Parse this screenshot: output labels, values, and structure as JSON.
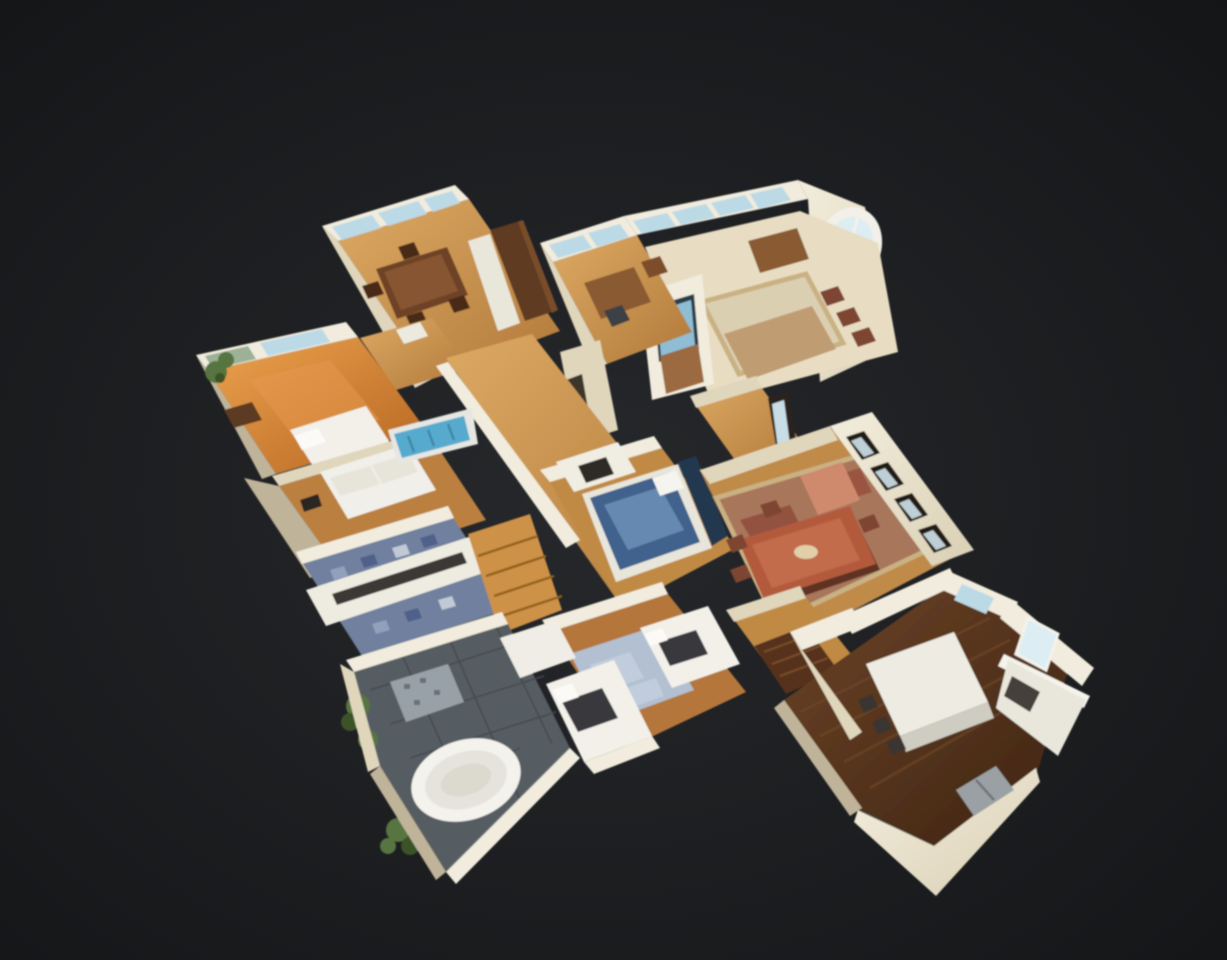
{
  "scene": {
    "description": "3D dollhouse cutaway view of a scanned single-story home interior, viewed from above at an angle, floating on a dark charcoal background with no visible UI chrome",
    "view": "dollhouse-orbit",
    "rooms": [
      {
        "name": "dining-room",
        "position": "top-left",
        "floor": "light oak",
        "features": [
          "picture-window wall",
          "dark wood dining table with chairs",
          "tall walnut hutch",
          "white cabinet"
        ]
      },
      {
        "name": "home-office",
        "position": "top-center",
        "floor": "light oak",
        "features": [
          "window wall",
          "wood desk",
          "office chair"
        ]
      },
      {
        "name": "formal-living-room",
        "position": "top-right",
        "floor": "light carpet",
        "features": [
          "arched palladian window",
          "french-window wall",
          "beige area rug",
          "tan sofa",
          "tv over fireplace",
          "writing desk",
          "row of side chairs"
        ]
      },
      {
        "name": "left-bedroom",
        "position": "left",
        "floor": "amber oak",
        "features": [
          "corner windows with greenery view",
          "white bed",
          "houseplant",
          "dresser"
        ]
      },
      {
        "name": "sitting-room",
        "position": "mid-left",
        "floor": "oak",
        "features": [
          "white loveseat",
          "wood dresser",
          "wall art"
        ]
      },
      {
        "name": "mosaic-bathroom",
        "position": "center-left",
        "floor": "blue mosaic tile",
        "features": [
          "long white double vanity"
        ]
      },
      {
        "name": "hallway-stairs",
        "position": "center",
        "floor": "light oak",
        "features": [
          "staircase with blue runner",
          "wood stair flight",
          "white cut walls"
        ]
      },
      {
        "name": "master-bedroom",
        "position": "center",
        "floor": "oak",
        "features": [
          "bed with blue duvet",
          "dark headboard",
          "white fireplace"
        ]
      },
      {
        "name": "formal-dining-room",
        "position": "right",
        "floor": "oak with red oriental rug",
        "features": [
          "long mahogany dining table",
          "dining chairs",
          "salmon armchair",
          "dark-framed french windows"
        ]
      },
      {
        "name": "kids-bedroom",
        "position": "bottom-center",
        "floor": "oak",
        "features": [
          "two white beds with dark blankets",
          "powder-blue rug"
        ]
      },
      {
        "name": "slate-bathroom",
        "position": "bottom-left",
        "floor": "slate tile",
        "features": [
          "white oval soaking tub",
          "mosaic shower pan",
          "houseplants",
          "white counter"
        ]
      },
      {
        "name": "kitchen",
        "position": "bottom-right",
        "floor": "dark walnut",
        "features": [
          "white island with stools",
          "white perimeter cabinets",
          "glass exterior door",
          "windows",
          "gray laundry appliances",
          "mudroom cut walls"
        ]
      }
    ]
  },
  "palette": {
    "bg_center": "#26282b",
    "bg_edge": "#131416",
    "wall_bright": "#f1ecdd",
    "wall_cream": "#e0d6bc",
    "wall_shadow": "#bfb49a",
    "glass": "#bcd9e6",
    "glass_bright": "#dcedf3",
    "glass_green": "#9cb196",
    "floor_travertine": "#e8ddc2",
    "floor_slate": "#575d62",
    "slate_line": "#45494d",
    "mosaic_base": "#70809e",
    "mosaic_light": "#93a0bc",
    "mosaic_dark": "#50608a",
    "mosaic_pale": "#c2c9d6",
    "rug_beige": "#dbcfb2",
    "rug_border": "#c9b183",
    "rug_oriental": "#a8765a",
    "rug_oriental_dark": "#8d4938",
    "rug_blue": "#b2c0d2",
    "table_dark_wood": "#6e4226",
    "table_mahogany": "#b35a3c",
    "table_mahogany_light": "#c4704f",
    "hutch_wood": "#5e3b21",
    "desk_wood": "#8a5a33",
    "sofa_tan": "#c09c72",
    "chair_salmon": "#cf8a6e",
    "chair_dark": "#7e4530",
    "bed_white": "#f2f0e9",
    "bed_blue": "#40628c",
    "bed_blue_light": "#6f93ba",
    "headboard_navy": "#243850",
    "blanket_dark": "#38383c",
    "plant_green": "#56743f",
    "plant_dark": "#3a5328",
    "stair_runner": "#57aacd",
    "stair_wood": "#cd9146",
    "stair_dark": "#56331b",
    "tv_screen": "#8ebdd4",
    "appliance_gray": "#9aa0a4",
    "appliance_dark": "#3a3630",
    "tub_white": "#f3f2ed",
    "tub_inner": "#e5e3db",
    "fire_brown": "#9c6a40"
  }
}
